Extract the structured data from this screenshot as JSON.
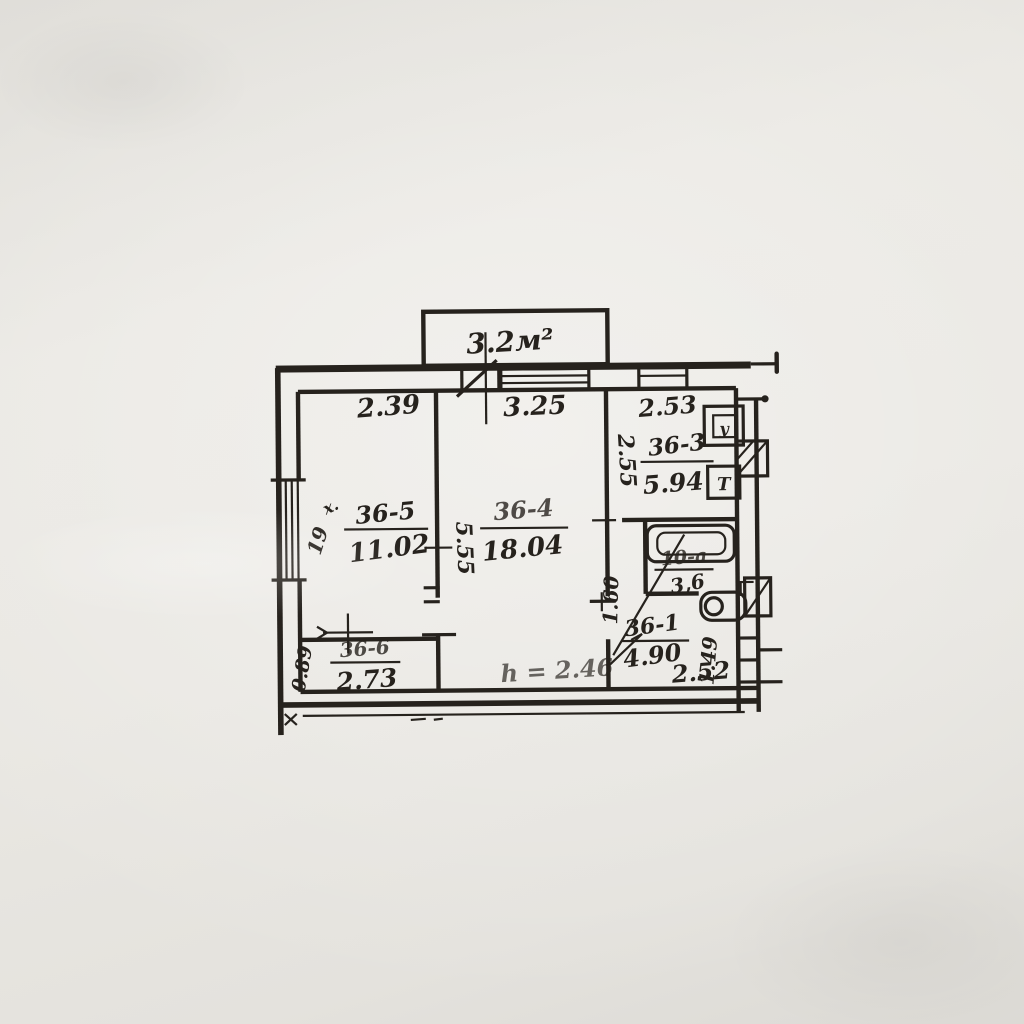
{
  "meta": {
    "description": "Hand-drawn BTI apartment floor plan (photocopy scan)",
    "paper_color": "#e9e7e2",
    "ink_color": "#26221d"
  },
  "balcony": {
    "area_label": "3.2м²"
  },
  "top_dimensions": {
    "room_36_5_width": "2.39",
    "room_36_4_width": "3.25",
    "kitchen_width": "2.53"
  },
  "rooms": {
    "room_36_5": {
      "number": "36-5",
      "area": "11.02",
      "corner_mark": "х.",
      "side_mark": "19"
    },
    "room_36_4": {
      "number": "36-4",
      "area": "18.04",
      "depth": "5.55"
    },
    "kitchen_36_3": {
      "number": "36-3",
      "area": "5.94",
      "depth": "2.55"
    },
    "bathroom": {
      "number": "10-а",
      "area": "3,6",
      "depth": "1.60"
    },
    "hall_36_1": {
      "number": "36-1",
      "area": "4.90",
      "width": "2.52",
      "depth": "1.49"
    },
    "closet_36_6": {
      "number": "36-6",
      "area": "2.73",
      "depth": "0.89"
    }
  },
  "annotations": {
    "ceiling_height": "h = 2.46"
  },
  "fixtures": {
    "vent_box_symbol": "у",
    "kitchen_box_symbol": "Т"
  }
}
